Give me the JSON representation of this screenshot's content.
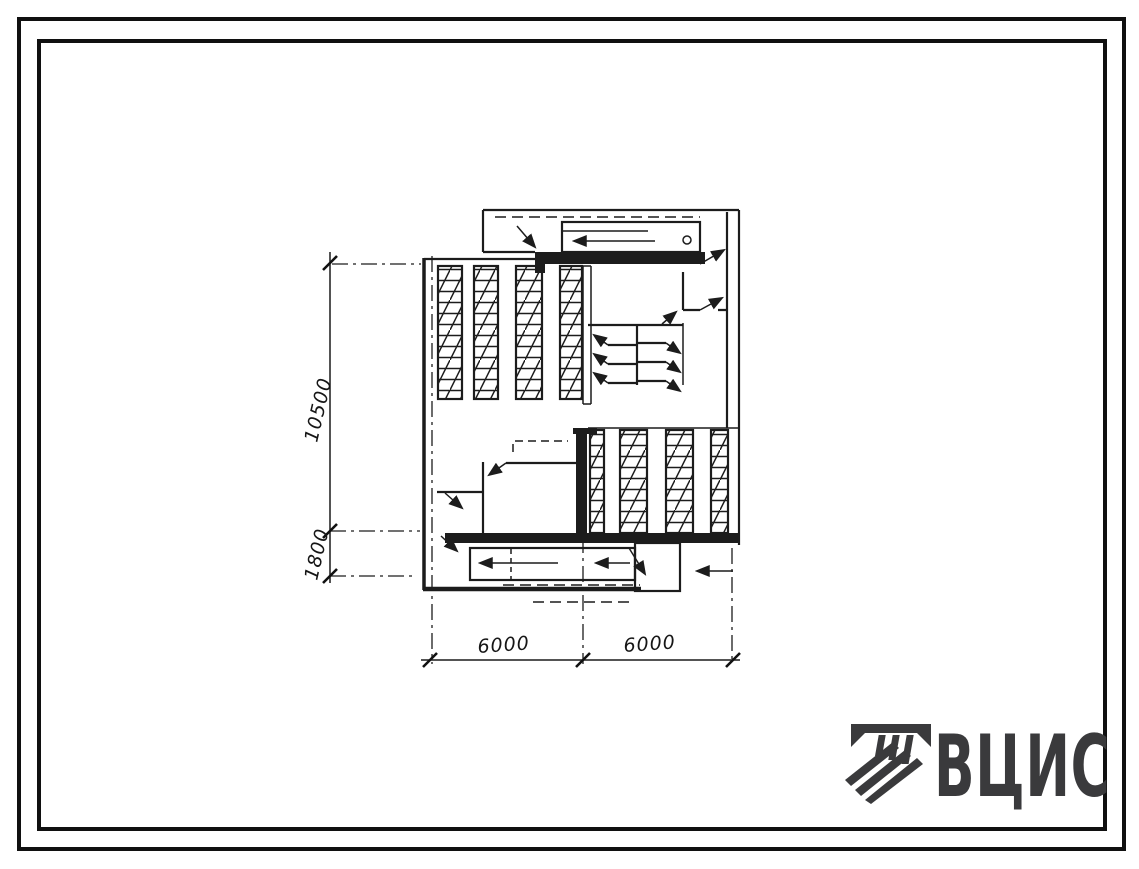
{
  "drawing": {
    "ink": "#1c1c1c",
    "dimensions": {
      "vertical": [
        {
          "label": "10500"
        },
        {
          "label": "1800"
        }
      ],
      "horizontal": [
        {
          "label": "6000"
        },
        {
          "label": "6000"
        }
      ]
    }
  },
  "logo": {
    "text": "ВЦИС",
    "color": "#3a3a3c",
    "icon": "hatched-beam-emblem-icon"
  }
}
